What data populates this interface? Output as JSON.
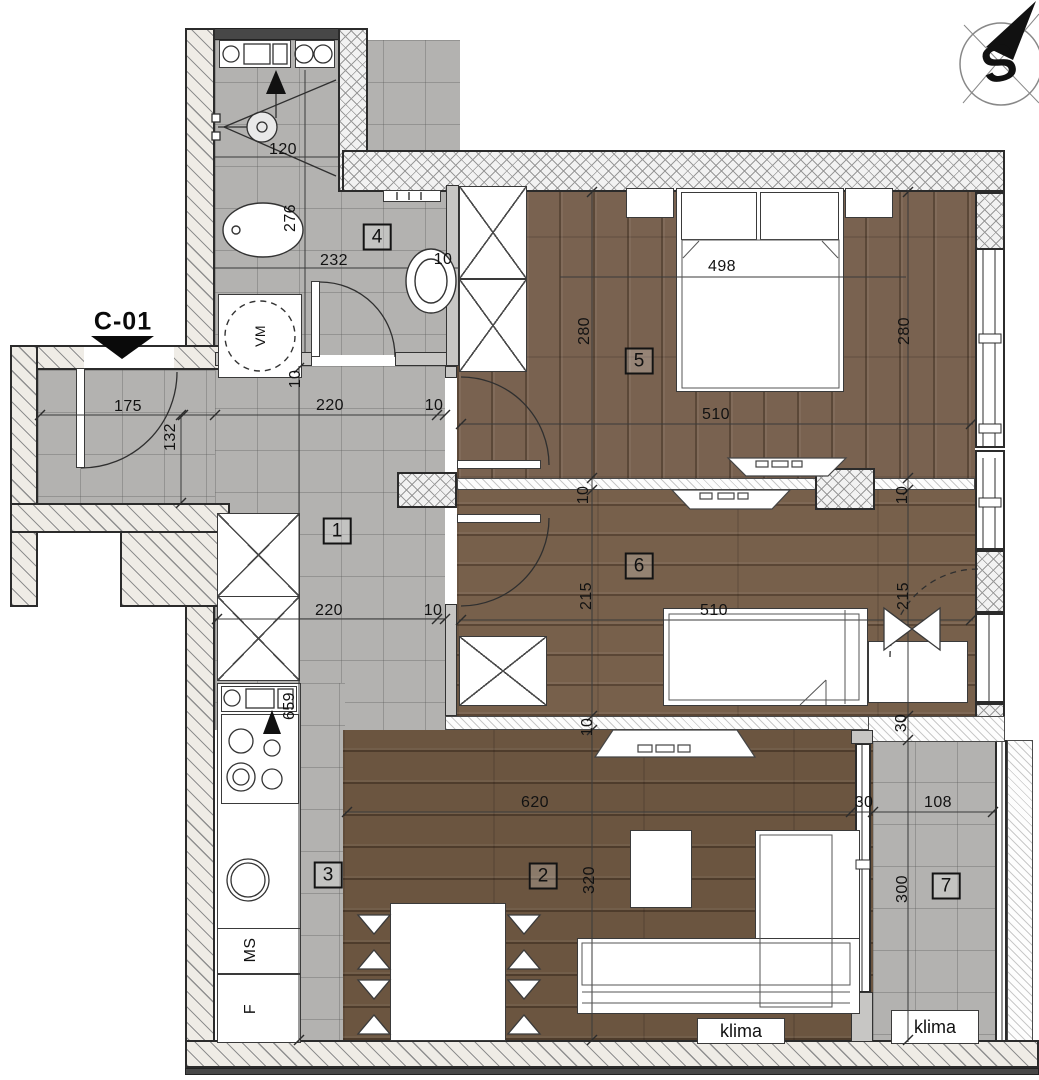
{
  "rooms": {
    "hall": "1",
    "living_room": "2",
    "kitchen": "3",
    "bathroom": "4",
    "bedroom_1": "5",
    "bedroom_2": "6",
    "balcony": "7"
  },
  "dims": {
    "shower_width": "120",
    "bath_depth": "276",
    "bath_width": "232",
    "bath_sink_gap": "10",
    "entry_width": "175",
    "entry_depth": "132",
    "hall_top_width": "220",
    "hall_top_gap": "10",
    "bath_wall_thk": "10",
    "hall_bottom_width": "220",
    "hall_bottom_gap": "10",
    "kitchen_run": "659",
    "bed_length": "498",
    "room5_depth_left": "280",
    "room5_width": "510",
    "room5_depth_right": "280",
    "wall56_thk_left": "10",
    "wall56_thk_right": "10",
    "room6_depth_left": "215",
    "room6_width": "510",
    "room6_depth_right": "215",
    "room6_bottom_thk": "10",
    "room6_bottom_right": "30",
    "living_width": "620",
    "living_depth": "320",
    "balcony_inset": "30",
    "balcony_width": "108",
    "balcony_depth": "300"
  },
  "labels": {
    "entrance": "C-01",
    "compass": "S",
    "washing_machine": "VM",
    "kitchen_cabinet": "MS",
    "fridge": "F",
    "ac_living": "klima",
    "ac_balcony": "klima"
  }
}
